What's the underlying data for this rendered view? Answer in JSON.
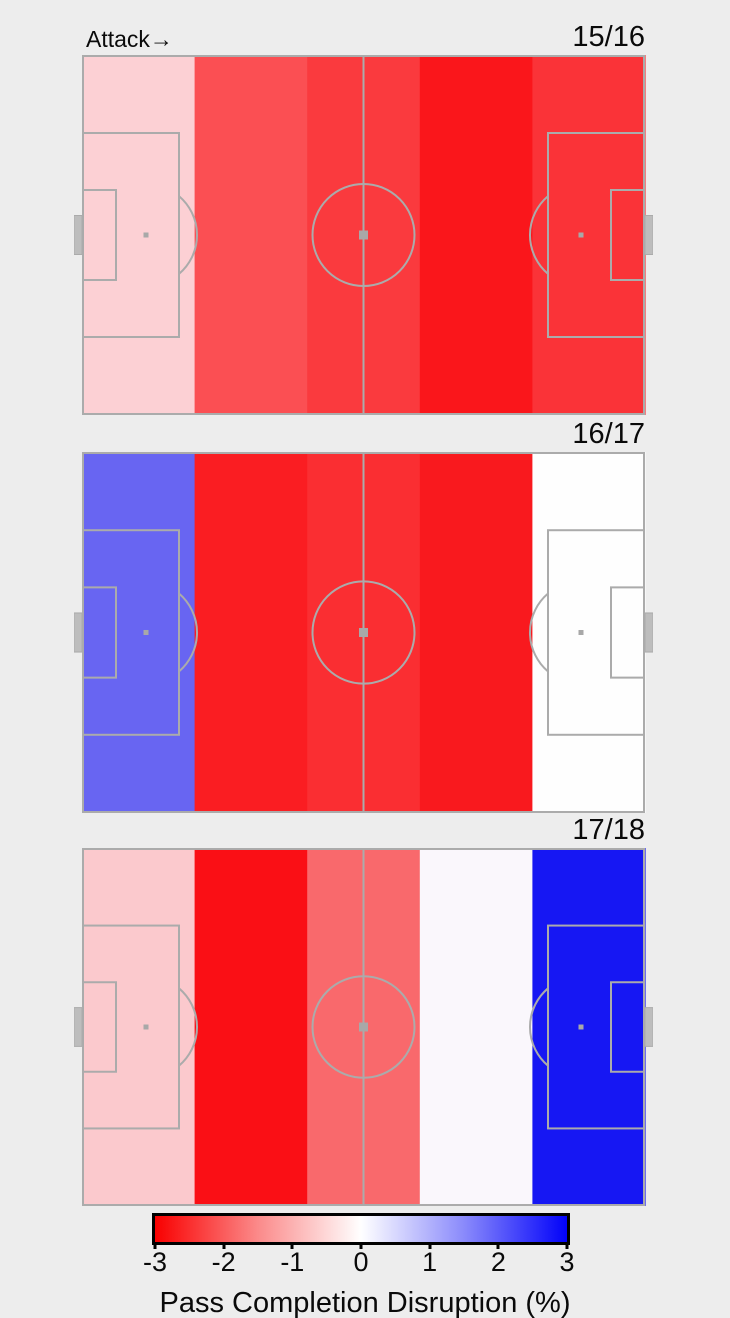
{
  "attack_label": "Attack→",
  "panels": [
    {
      "season": "15/16",
      "zone_colors": [
        "#fcd0d4",
        "#fb4f53",
        "#fa3a3e",
        "#fa161b",
        "#fa3338"
      ]
    },
    {
      "season": "16/17",
      "zone_colors": [
        "#6865f2",
        "#fa1d22",
        "#fa2e32",
        "#f9191e",
        "#fefefe"
      ]
    },
    {
      "season": "17/18",
      "zone_colors": [
        "#fbc9cd",
        "#fa0f15",
        "#f9696c",
        "#faf7fc",
        "#1617f3"
      ]
    }
  ],
  "pitch_style": {
    "line_color": "#ababab",
    "marker_color": "#a8a8a8",
    "goal_fill": "#bdbdbd",
    "background": "#ededed"
  },
  "colorbar": {
    "label": "Pass Completion Disruption (%)",
    "ticks": [
      "-3",
      "-2",
      "-1",
      "0",
      "1",
      "2",
      "3"
    ],
    "min": -3,
    "max": 3,
    "left_color": "#f90000",
    "mid_color": "#ffffff",
    "right_color": "#0202f9"
  },
  "chart_data": {
    "type": "heatmap",
    "title": "",
    "attack_direction": "left-to-right",
    "zones_per_pitch": 5,
    "categories": [
      "zone1-defensive-fifth",
      "zone2",
      "zone3-middle-fifth",
      "zone4",
      "zone5-attacking-fifth"
    ],
    "series": [
      {
        "name": "15/16",
        "values": [
          -0.6,
          -2.1,
          -2.3,
          -2.7,
          -2.4
        ]
      },
      {
        "name": "16/17",
        "values": [
          1.8,
          -2.7,
          -2.4,
          -2.7,
          0.0
        ]
      },
      {
        "name": "17/18",
        "values": [
          -0.6,
          -2.8,
          -1.9,
          0.1,
          2.9
        ]
      }
    ],
    "colormap": "red-white-blue",
    "colorbar_label": "Pass Completion Disruption (%)",
    "colorbar_range": [
      -3,
      3
    ],
    "colorbar_ticks": [
      -3,
      -2,
      -1,
      0,
      1,
      2,
      3
    ],
    "legend_position": "bottom",
    "grid": false
  }
}
